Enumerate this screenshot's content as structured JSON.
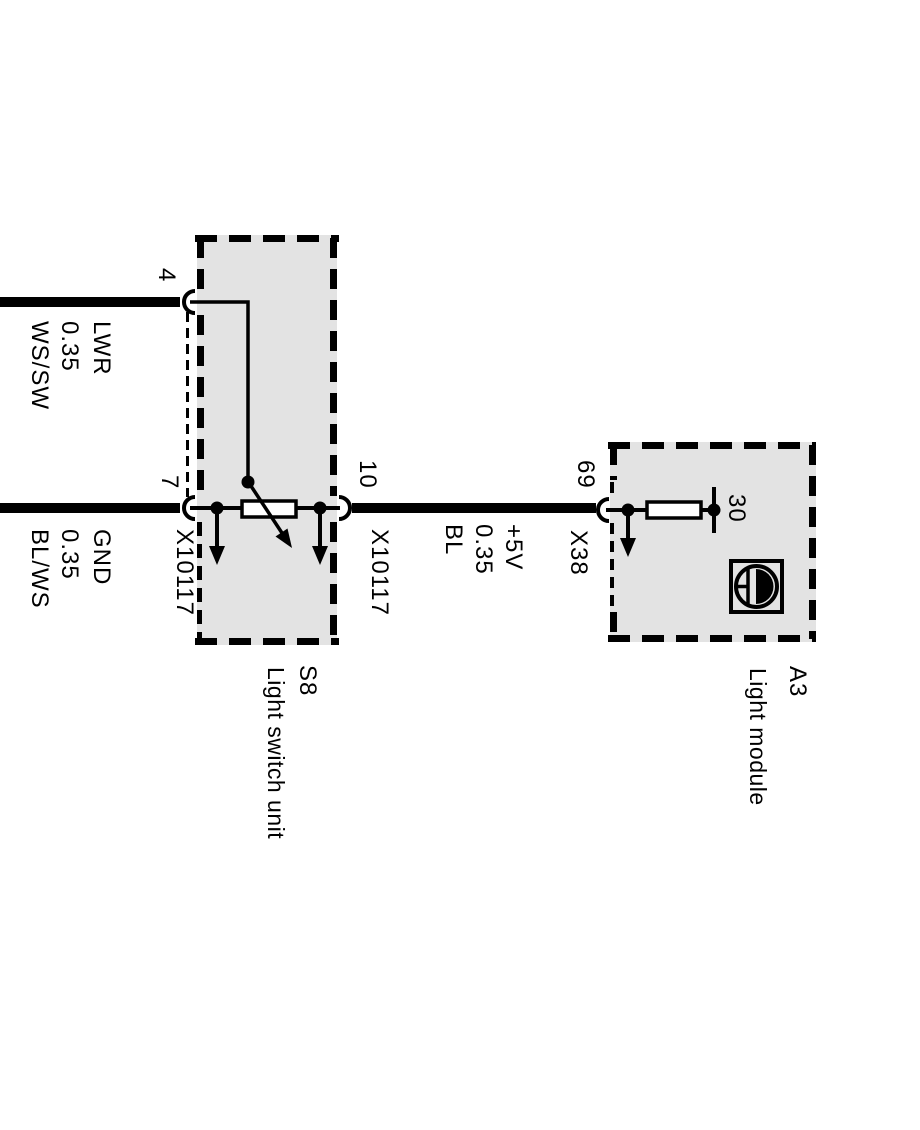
{
  "diagram": {
    "title_hint": "light switch wiring",
    "colors": {
      "background": "#ffffff",
      "line": "#000000",
      "box_fill": "#e3e3e3",
      "symbol_fill": "#ffffff"
    },
    "wires": [
      {
        "signal": "LWR",
        "gauge": "0.35",
        "color_code": "WS/SW"
      },
      {
        "signal": "GND",
        "gauge": "0.35",
        "color_code": "BL/WS"
      },
      {
        "signal": "+5V",
        "gauge": "0.35",
        "color_code": "BL"
      }
    ],
    "pins": {
      "switch_pin_top": "4",
      "switch_pin_bottom": "7",
      "switch_pin_out": "10",
      "module_pin_in": "69",
      "terminal_30": "30"
    },
    "connectors": {
      "x10117_left": "X10117",
      "x10117_right": "X10117",
      "x38": "X38"
    },
    "components": {
      "light_switch": {
        "id": "S8",
        "label": "Light switch unit"
      },
      "light_module": {
        "id": "A3",
        "label": "Light module"
      }
    }
  }
}
